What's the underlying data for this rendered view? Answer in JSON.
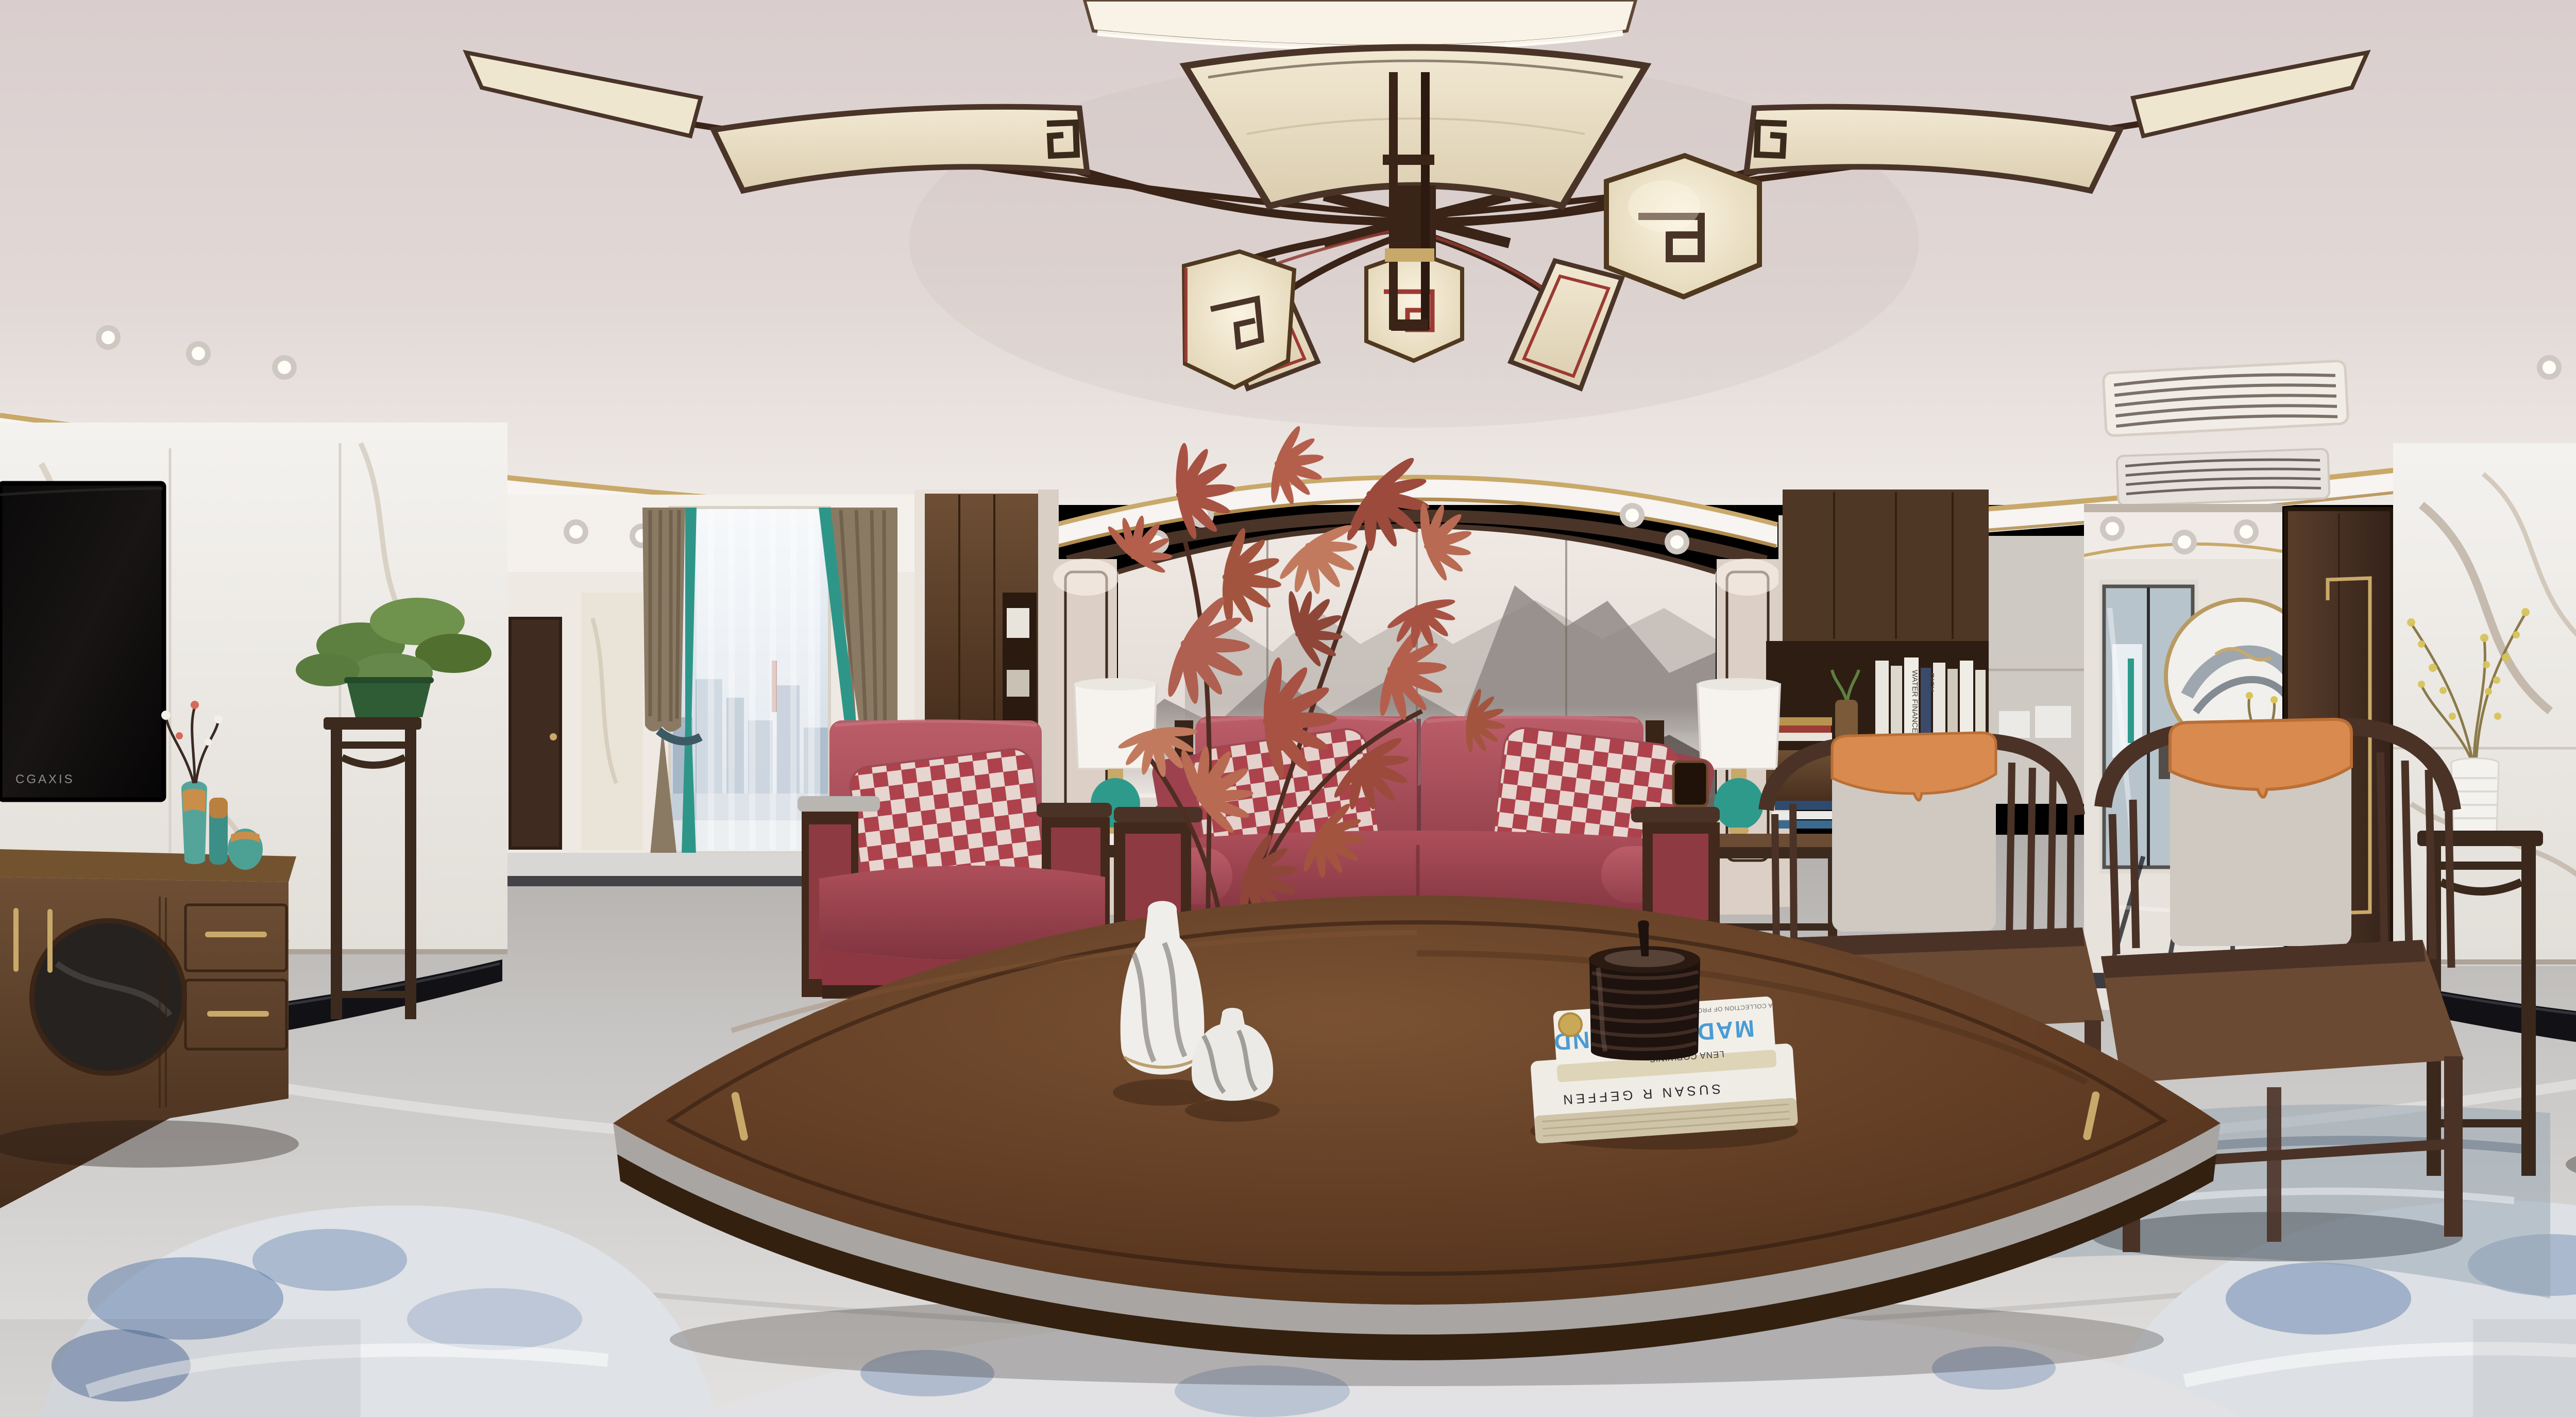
{
  "scene": {
    "kind": "photograph",
    "subtype": "360-degree equirectangular panorama of a new-Chinese-style living room",
    "texts": {
      "tv_brand": "CGAXIS",
      "book_top_author": "LENA CORWIN'S",
      "book_top_title": "MADE BY HAND",
      "book_top_subtitle": "A COLLECTION OF PROJECTS TO PRINT, SEW, WEAVE,",
      "book_bottom_spine": "SUSAN R GEFFEN",
      "shelf_spine_1": "WATER FINANCE",
      "shelf_spine_2": "DICH"
    },
    "palette": {
      "ceiling": "#ded4d2",
      "cove_white": "#f7f4f1",
      "gold_trim": "#c9a96a",
      "marble_wall": "#f0eeea",
      "marble_vein": "#9c8a74",
      "wood_dark": "#3a2317",
      "wood_cabinet": "#5d4430",
      "wood_table": "#5a3a26",
      "sofa_red": "#a84b55",
      "pillow_check_red": "#b3454f",
      "teal_accent": "#2e9a8c",
      "orange_accent": "#d98a4e",
      "maple_leaf_red": "#b06050",
      "mural_ink_grey": "#6e6562",
      "floor_marble": "#cdcbc9",
      "floor_black_inlay": "#121216",
      "rug_blue": "#5878a8",
      "lantern_fabric": "#efe5d2",
      "book_title_blue": "#4a9bd4",
      "bonsai_green": "#6f924c",
      "sky_window": "#dfe8ef"
    },
    "objects": [
      {
        "name": "fan-blade-chandelier",
        "note": "chinese fan-shaped ceiling lamp with fabric blades and lanterns"
      },
      {
        "name": "wall-tv-left",
        "note": "black flat tv on white marble wall, panorama left edge"
      },
      {
        "name": "wall-tv-right",
        "note": "same tv wrapped to right edge"
      },
      {
        "name": "tv-cabinet-left",
        "note": "dark wood media cabinet with round stone inset and brass handles"
      },
      {
        "name": "tv-cabinet-right",
        "note": "dark wood media cabinet with brass handles"
      },
      {
        "name": "gold-wire-mountain-sculpture",
        "note": "brass rods with small birds on right cabinet"
      },
      {
        "name": "bonsai-on-plant-stand",
        "note": "green bonsai in glazed pot on tall wooden stand"
      },
      {
        "name": "hallway-window",
        "note": "floor-to-ceiling window with sheer, city skyline view"
      },
      {
        "name": "curtains",
        "note": "linen curtains with teal edge bands"
      },
      {
        "name": "red-leather-armchair",
        "note": "single armchair with red-white checkered pillow"
      },
      {
        "name": "red-leather-sofa",
        "note": "two-seat red leather sofa with wood frame, checkered pillows, bolsters"
      },
      {
        "name": "ink-mountain-mural-wall",
        "note": "four-panel ink-wash mountain mural behind sofa"
      },
      {
        "name": "fabric-wall-panels",
        "note": "beige panels with dark outline flanking mural"
      },
      {
        "name": "red-maple-plant",
        "note": "red maple branches in front of mural"
      },
      {
        "name": "marble-glaze-vases",
        "note": "two white-grey ceramic vases on coffee table"
      },
      {
        "name": "black-ceramic-jar",
        "note": "glossy ribbed dark jar on book stack"
      },
      {
        "name": "art-books",
        "note": "two white books under jar"
      },
      {
        "name": "coffee-table",
        "note": "huge curved dark walnut table, brass handles"
      },
      {
        "name": "table-lamps-pair",
        "note": "white drum shades with teal gourd bases flanking sofa"
      },
      {
        "name": "wooden-armchairs-pair",
        "note": "ming-style chairs with grey cushions and orange caps"
      },
      {
        "name": "bookshelf-cabinet",
        "note": "dark wood wall unit with book shelf"
      },
      {
        "name": "corridor-glass-doors",
        "note": "hallway to another room with sliding glass doors"
      },
      {
        "name": "moon-art-sideboard",
        "note": "round ink art over small chest with vases and yellow flowers"
      },
      {
        "name": "wooden-entry-door",
        "note": "dark door with brass inlay trim"
      },
      {
        "name": "flower-plant-stand-right",
        "note": "white ribbed vase with yellow branches on tall stand"
      },
      {
        "name": "area-rug",
        "note": "abstract blue-white rug on grey marble floor"
      },
      {
        "name": "marble-floor",
        "note": "grey marble with black curved inlay bands"
      },
      {
        "name": "ac-vents",
        "note": "linear ceiling air grilles over right corridor"
      }
    ]
  }
}
